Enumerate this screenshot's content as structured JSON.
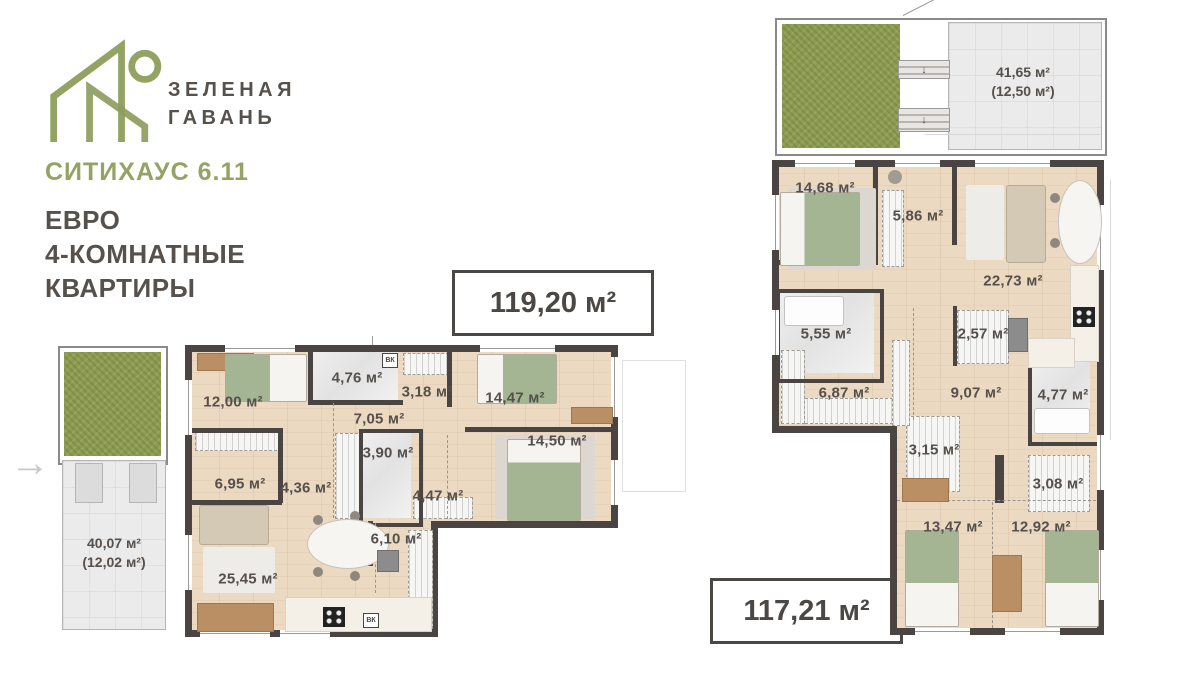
{
  "colors": {
    "accent": "#94a364",
    "ink": "#55504c",
    "wall": "#4a4442"
  },
  "brand": {
    "name_line1": "ЗЕЛЕНАЯ",
    "name_line2": "ГАВАНЬ"
  },
  "header": {
    "project": "СИТИХАУС 6.11",
    "subtitle_line1": "ЕВРО",
    "subtitle_line2": "4-КОМНАТНЫЕ",
    "subtitle_line3": "КВАРТИРЫ"
  },
  "icons": {
    "entry_arrow": "→",
    "stairs_down": "↓"
  },
  "plans": [
    {
      "total_area": "119,20 м²",
      "vent_label": "ВК",
      "terrace": {
        "area": "40,07 м²",
        "area_secondary": "(12,02 м²)"
      },
      "rooms": [
        {
          "label": "12,00 м²"
        },
        {
          "label": "4,76 м²"
        },
        {
          "label": "3,18 м²"
        },
        {
          "label": "14,47 м²"
        },
        {
          "label": "7,05 м²"
        },
        {
          "label": "3,90 м²"
        },
        {
          "label": "14,50 м²"
        },
        {
          "label": "6,95 м²"
        },
        {
          "label": "4,36 м²"
        },
        {
          "label": "4,47 м²"
        },
        {
          "label": "6,10 м²"
        },
        {
          "label": "25,45 м²"
        }
      ]
    },
    {
      "total_area": "117,21 м²",
      "terrace": {
        "area": "41,65 м²",
        "area_secondary": "(12,50 м²)"
      },
      "rooms": [
        {
          "label": "14,68 м²"
        },
        {
          "label": "5,86 м²"
        },
        {
          "label": "22,73 м²"
        },
        {
          "label": "5,55 м²"
        },
        {
          "label": "2,57 м²"
        },
        {
          "label": "6,87 м²"
        },
        {
          "label": "9,07 м²"
        },
        {
          "label": "4,77 м²"
        },
        {
          "label": "3,15 м²"
        },
        {
          "label": "3,08 м²"
        },
        {
          "label": "13,47 м²"
        },
        {
          "label": "12,92 м²"
        }
      ]
    }
  ]
}
